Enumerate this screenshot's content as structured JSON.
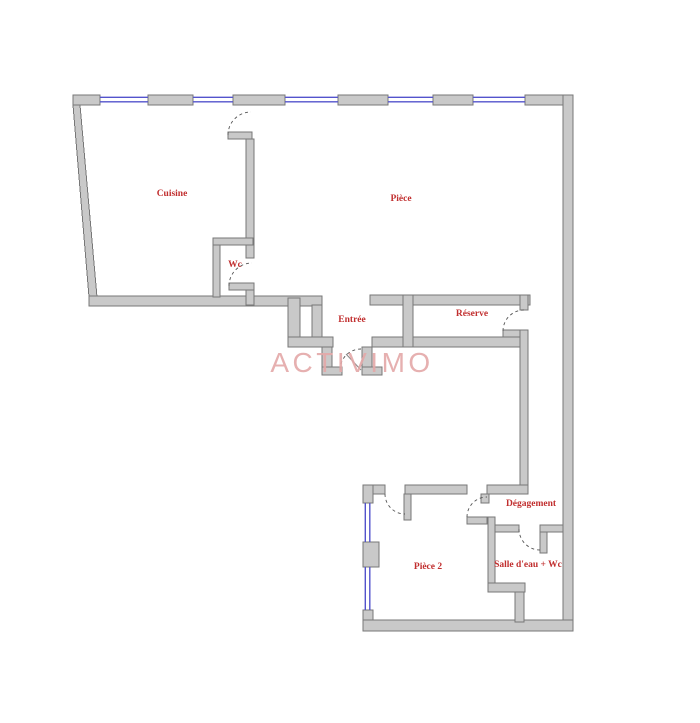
{
  "plan": {
    "watermark": "ACTIVIMO",
    "rooms": {
      "cuisine": {
        "label": "Cuisine"
      },
      "piece": {
        "label": "Pièce"
      },
      "wc": {
        "label": "Wc"
      },
      "entree": {
        "label": "Entrée"
      },
      "reserve": {
        "label": "Réserve"
      },
      "degagement": {
        "label": "Dégagement"
      },
      "piece2": {
        "label": "Pièce 2"
      },
      "salle_eau": {
        "label": "Salle d'eau + Wc"
      }
    },
    "colors": {
      "background": "#ffffff",
      "wall_fill": "#c9c9c9",
      "wall_edge": "#777777",
      "window": "#5353cc",
      "label": "#c12f2f",
      "watermark": "#e4a8a8"
    }
  }
}
